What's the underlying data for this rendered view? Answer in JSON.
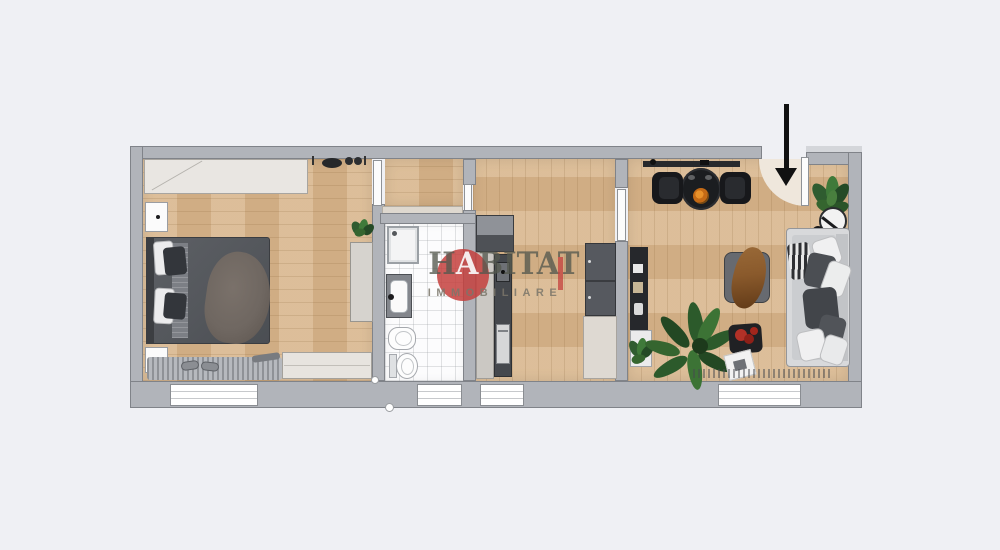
{
  "watermark": {
    "brand_part1": "H",
    "brand_part2": "A",
    "brand_part3": "BITAT",
    "subtitle": "IMMOBILIARE",
    "red_circle_color": "#C4403D",
    "text_color": "#55584E"
  },
  "entrance": {
    "arrow_icon": "down-arrow-icon",
    "arrow_color": "#111111",
    "door_swing_color": "#EFE7DC"
  },
  "palette": {
    "background": "#EFF0F4",
    "wall": "#B1B4BA",
    "wood_floor": "#D7B58C",
    "tile_floor": "#FCFCFD",
    "dark_furniture": "#45484D",
    "beige_furniture": "#DED9D2",
    "sofa": "#D8D9DB"
  },
  "rooms": [
    {
      "name": "bedroom"
    },
    {
      "name": "hallway"
    },
    {
      "name": "bathroom"
    },
    {
      "name": "kitchen"
    },
    {
      "name": "living-room"
    }
  ]
}
